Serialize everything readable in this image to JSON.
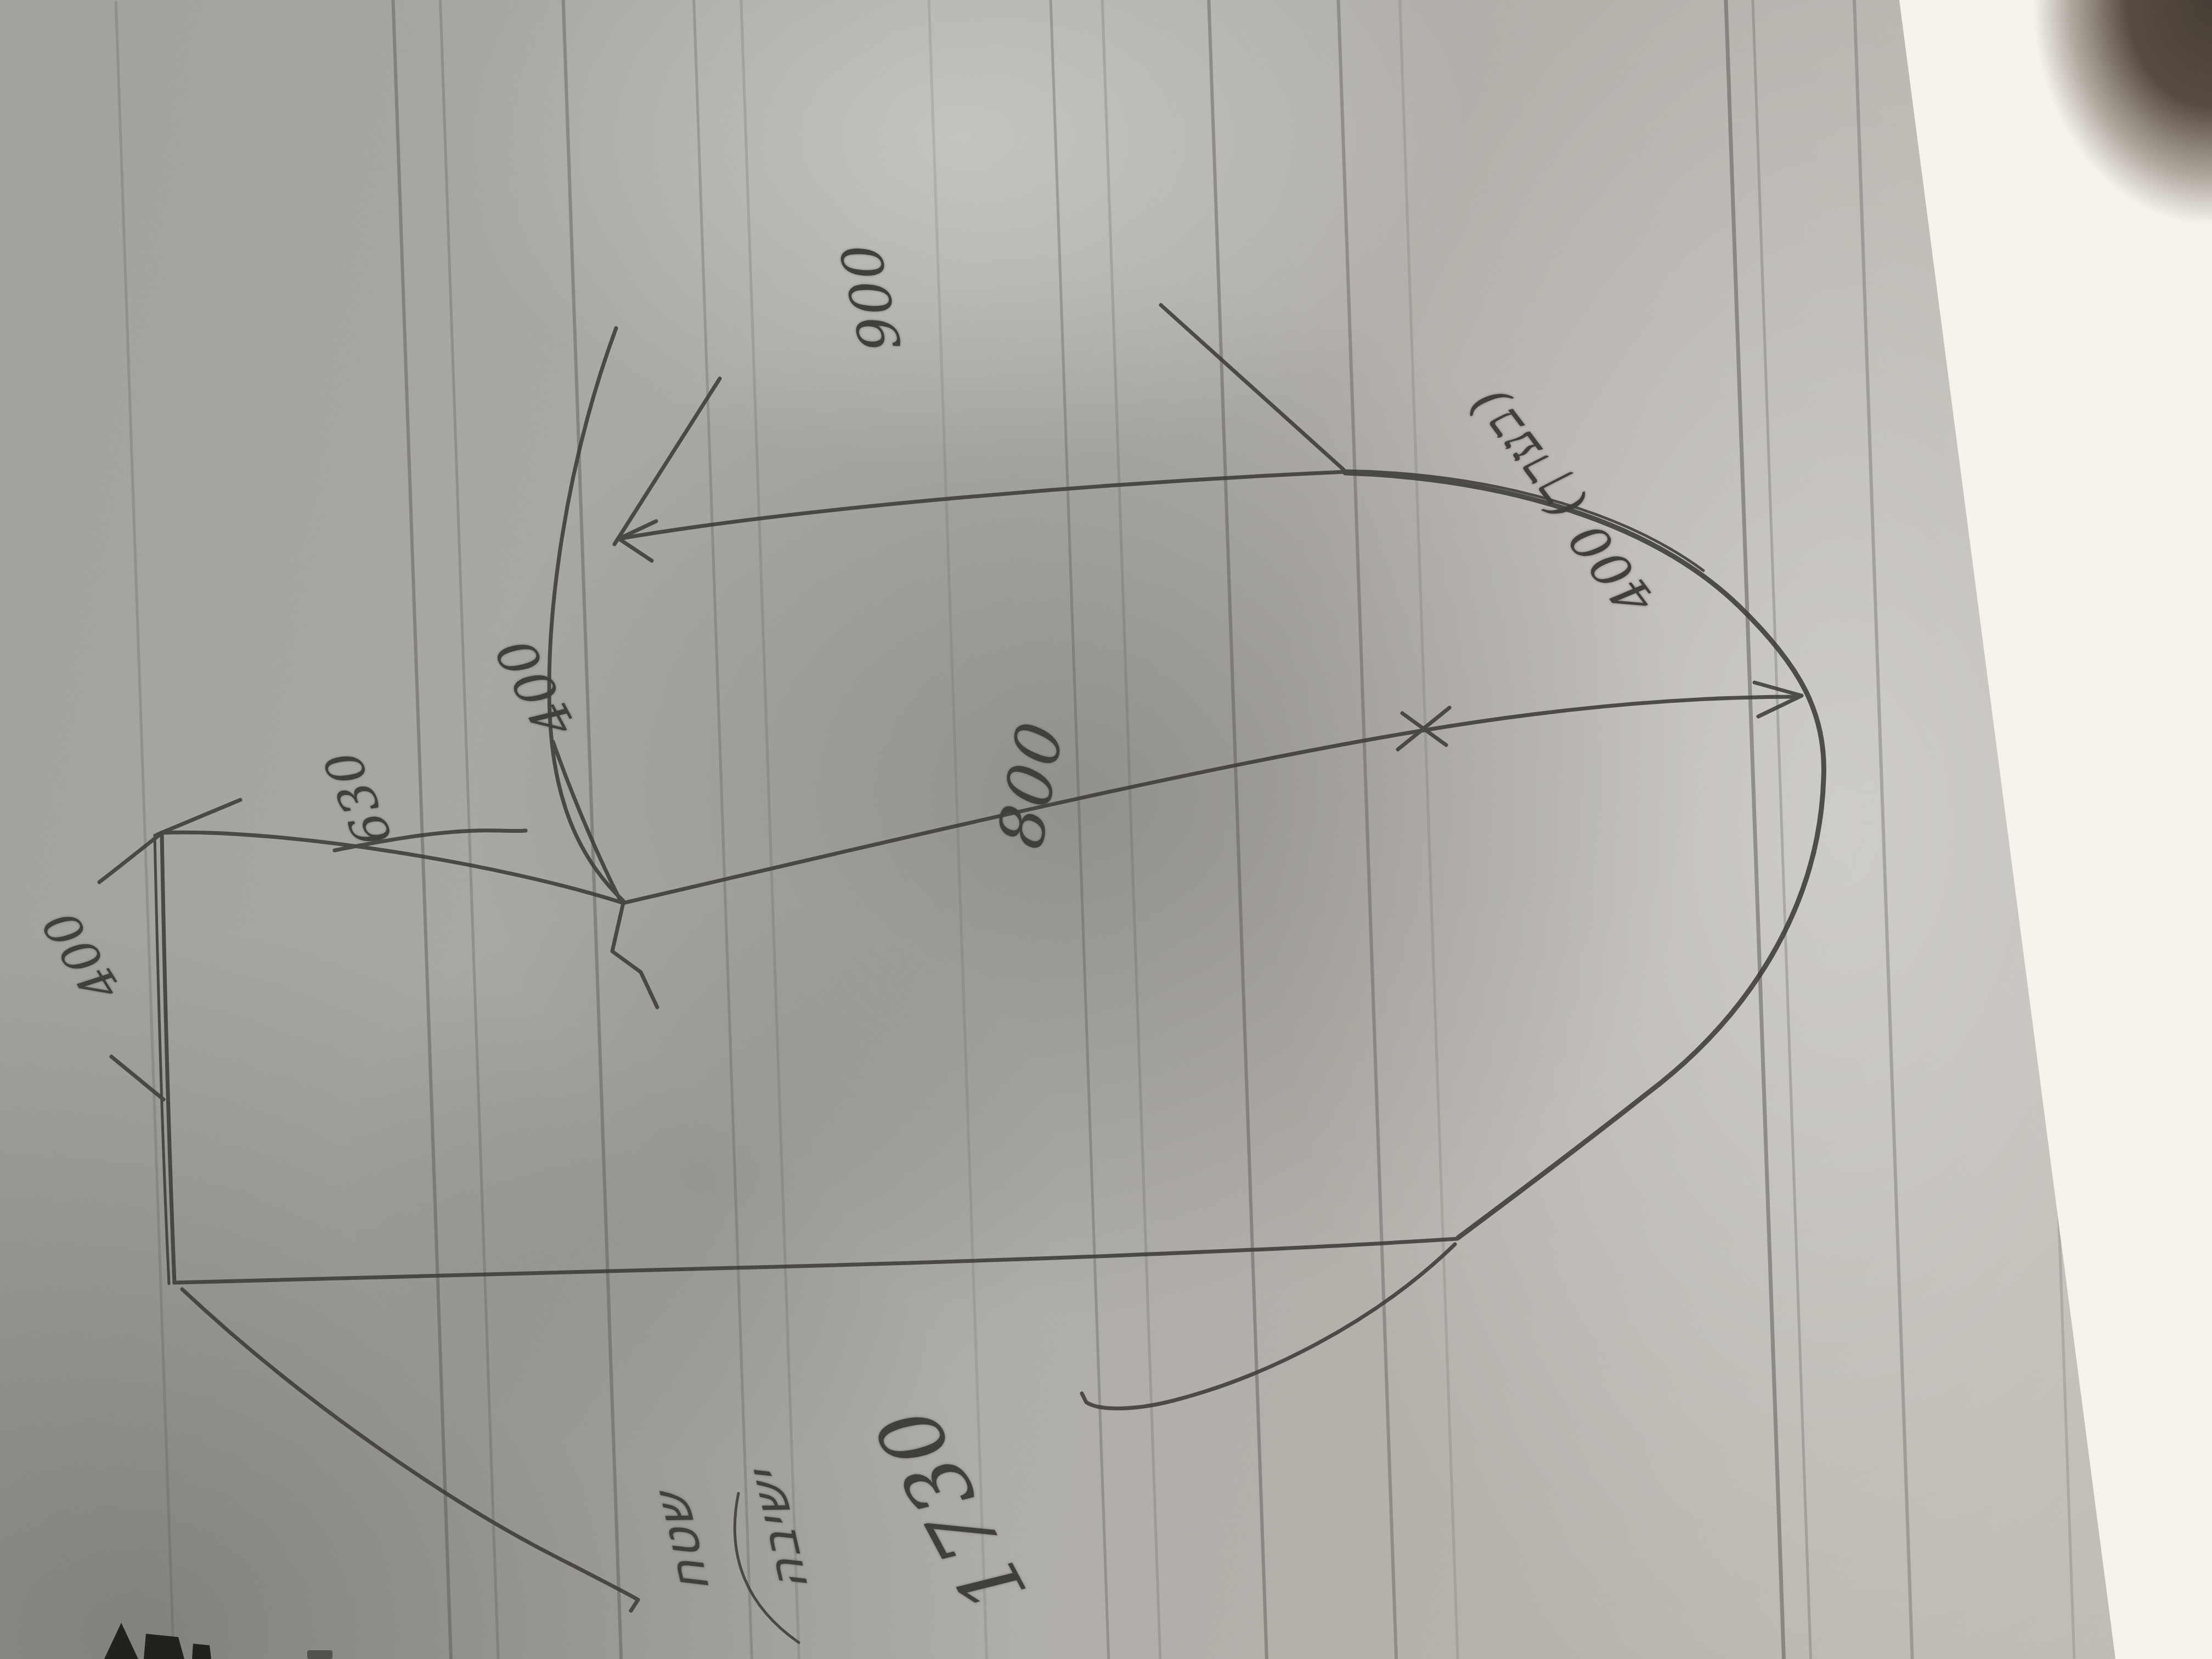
{
  "sketch": {
    "labels": {
      "width_top": "900",
      "width_offset": "400",
      "segment_left": "630",
      "segment_middle": "800",
      "segment_end": "400 (\u05d1\u05e2\u05e8\u05da)",
      "depth_left": "400",
      "length_total": "1730",
      "note": "\u05e9\u05d8\u05d7\n\u05d9\u05e9\u05d9\u05d1\u05d4"
    },
    "colors": {
      "paper": "#aba9a3",
      "pencil": "#3e3c38",
      "white_sheet": "#f6f3ec",
      "dark_corner": "#443b33"
    }
  }
}
